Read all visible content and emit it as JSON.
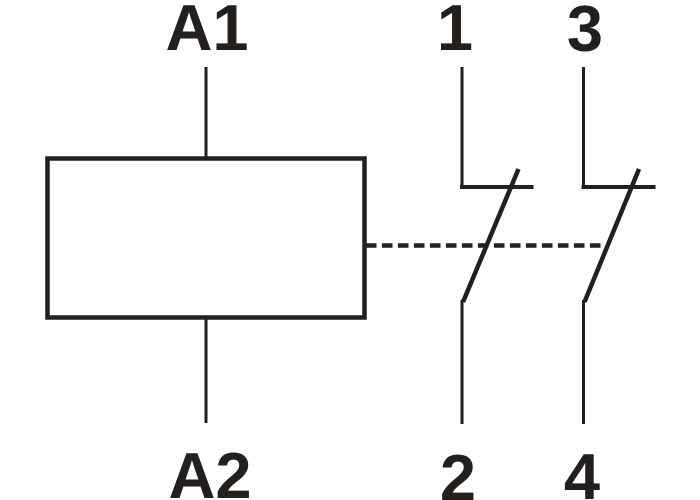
{
  "diagram": {
    "line_color": "#231f1c",
    "background_color": "#ffffff",
    "coil": {
      "top_terminal": "A1",
      "bottom_terminal": "A2"
    },
    "contacts": [
      {
        "top_terminal": "1",
        "bottom_terminal": "2"
      },
      {
        "top_terminal": "3",
        "bottom_terminal": "4"
      }
    ]
  }
}
